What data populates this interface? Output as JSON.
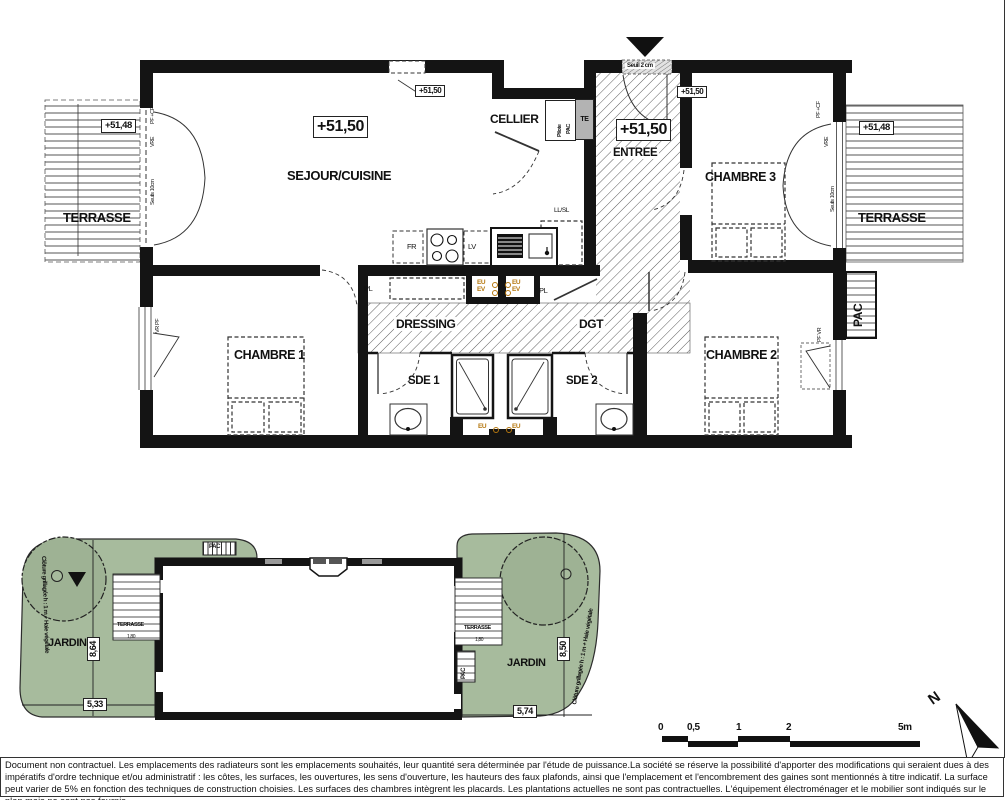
{
  "floor_plan": {
    "levels": {
      "sejour": "+51,50",
      "window": "+51,50",
      "entree": "+51,50",
      "chambre3": "+51,50",
      "terrasse_left": "+51,48",
      "terrasse_right": "+51,48"
    },
    "rooms": {
      "sejour": "SEJOUR/CUISINE",
      "cellier": "CELLIER",
      "entree": "ENTREE",
      "chambre3": "CHAMBRE 3",
      "terrasse_left": "TERRASSE",
      "terrasse_right": "TERRASSE",
      "chambre1": "CHAMBRE 1",
      "chambre2": "CHAMBRE 2",
      "dressing": "DRESSING",
      "dgt": "DGT",
      "sde1": "SDE 1",
      "sde2": "SDE 2"
    },
    "equipment": {
      "fr": "FR",
      "lv": "LV",
      "ll_sl": "LL/SL",
      "pl_left": "PL",
      "pl_right": "PL",
      "te": "TE",
      "pilote_line1": "Pilote",
      "pilote_line2": "PAC",
      "pac_unit": "PAC",
      "eu1": "EU",
      "ev1": "EV",
      "eu2": "EU",
      "ev2": "EV",
      "eu3": "EU",
      "eu4": "EU"
    },
    "openings": {
      "seuil_entree": "Seuil 2 cm",
      "pf_cf_left": "PF +CF",
      "vre_left": "VRE",
      "seuils_left": "Seuils 10cm",
      "pf_cf_right": "PF +CF",
      "vre_right": "VRE",
      "seuils_right": "Seuils 10cm",
      "vr_pf_ch1": "VR PF",
      "pf_vr_ch2": "PF VR"
    }
  },
  "site_plan": {
    "jardin_left": {
      "name": "JARDIN",
      "depth": "8,64",
      "width": "5,33",
      "fence": "Clôture grillagée h : 1 m + Haie végétale",
      "terrasse": "TERRASSE",
      "terrasse_width": "1,80"
    },
    "jardin_right": {
      "name": "JARDIN",
      "depth": "8,50",
      "width": "5,74",
      "fence": "Clôture grillagée h : 1 m + Haie végétale",
      "terrasse": "TERRASSE",
      "terrasse_width": "1,80"
    },
    "pac_top": "PAC",
    "pac_right": "PAC"
  },
  "scale_bar": {
    "t0": "0",
    "t05": "0,5",
    "t1": "1",
    "t2": "2",
    "t5": "5m"
  },
  "compass": {
    "north": "N"
  },
  "footer": {
    "disclaimer": "Document non contractuel. Les emplacements des radiateurs sont les emplacements souhaités, leur quantité sera déterminée par l'étude de puissance.La société se réserve la possibilité d'apporter des modifications qui seraient dues à des impératifs d'ordre technique et/ou administratif : les côtes, les surfaces, les ouvertures, les sens d'ouverture, les hauteurs des faux plafonds, ainsi que l'emplacement et l'encombrement des gaines sont mentionnés à titre indicatif. La surface peut varier de 5% en fonction des techniques de construction choisies. Les surfaces des chambres intègrent les placards. Les plantations actuelles ne sont pas contractuelles. L'équipement électroménager et le mobilier sont indiqués sur le plan mais ne sont pas fournis."
  }
}
